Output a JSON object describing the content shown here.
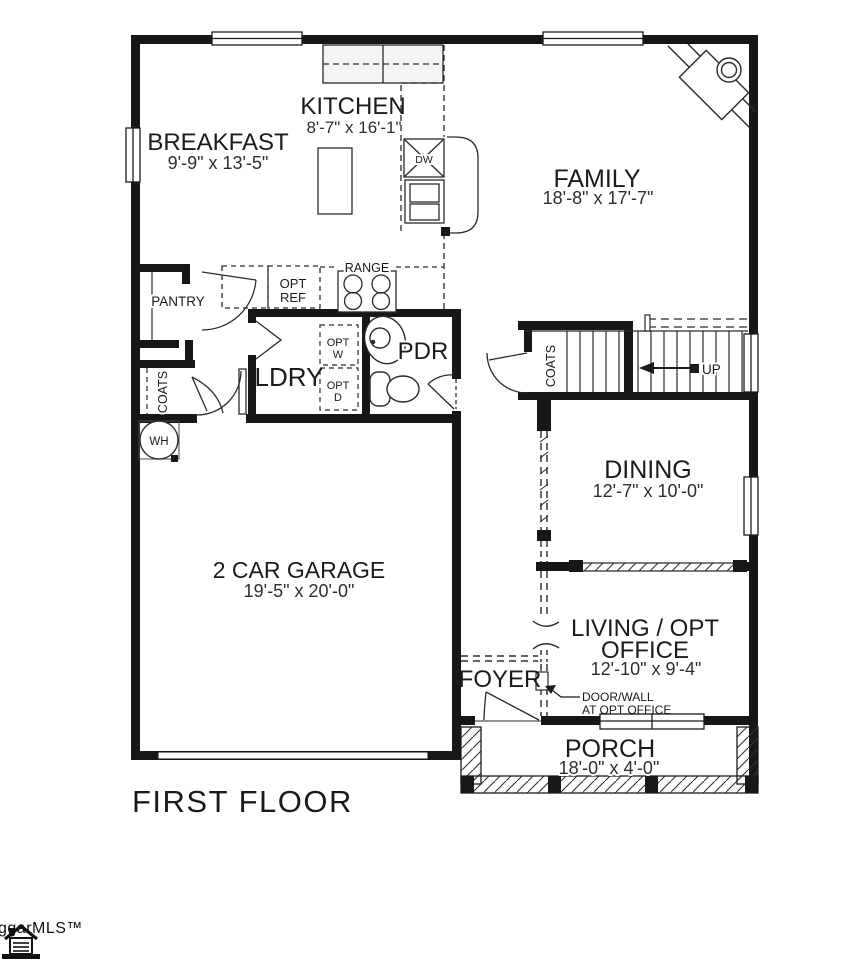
{
  "plan": {
    "title": "FIRST FLOOR",
    "watermark": "ggarMLS™",
    "rooms": {
      "breakfast": {
        "name": "BREAKFAST",
        "dims": "9'-9\" x 13'-5\""
      },
      "kitchen": {
        "name": "KITCHEN",
        "dims": "8'-7\" x 16'-1\""
      },
      "family": {
        "name": "FAMILY",
        "dims": "18'-8\" x 17'-7\""
      },
      "dining": {
        "name": "DINING",
        "dims": "12'-7\" x 10'-0\""
      },
      "garage": {
        "name": "2 CAR GARAGE",
        "dims": "19'-5\" x 20'-0\""
      },
      "living": {
        "line1": "LIVING / OPT",
        "line2": "OFFICE",
        "dims": "12'-10\" x 9'-4\""
      },
      "porch": {
        "name": "PORCH",
        "dims": "18'-0\" x 4'-0\""
      },
      "foyer": {
        "name": "FOYER"
      },
      "pantry": {
        "name": "PANTRY"
      },
      "ldry": {
        "name": "LDRY"
      },
      "pdr": {
        "name": "PDR"
      },
      "coats_hall": {
        "name": "COATS"
      },
      "coats_stairs": {
        "name": "COATS"
      }
    },
    "labels": {
      "range": "RANGE",
      "opt_ref_1": "OPT",
      "opt_ref_2": "REF",
      "opt_w_1": "OPT",
      "opt_w_2": "W",
      "opt_d_1": "OPT",
      "opt_d_2": "D",
      "dw": "DW",
      "wh": "WH",
      "up": "UP",
      "note_1": "DOOR/WALL",
      "note_2": "AT OPT OFFICE"
    }
  }
}
